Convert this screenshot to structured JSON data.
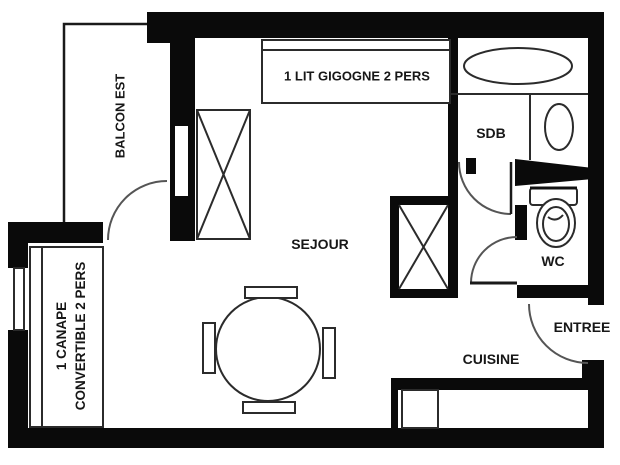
{
  "plan": {
    "type": "apartment-floor-plan",
    "background": "#ffffff",
    "wall_color": "#0a0a0a",
    "furniture_line_color": "#2b2b2b",
    "door_arc_color": "#555555",
    "text_color": "#171717",
    "labels": {
      "balcony": "BALCON EST",
      "bed": "1 LIT GIGOGNE 2 PERS",
      "bathroom": "SDB",
      "living_room": "SEJOUR",
      "toilet": "WC",
      "entrance": "ENTREE",
      "kitchen": "CUISINE",
      "sofa_line1": "1 CANAPE",
      "sofa_line2": "CONVERTIBLE 2 PERS"
    }
  }
}
